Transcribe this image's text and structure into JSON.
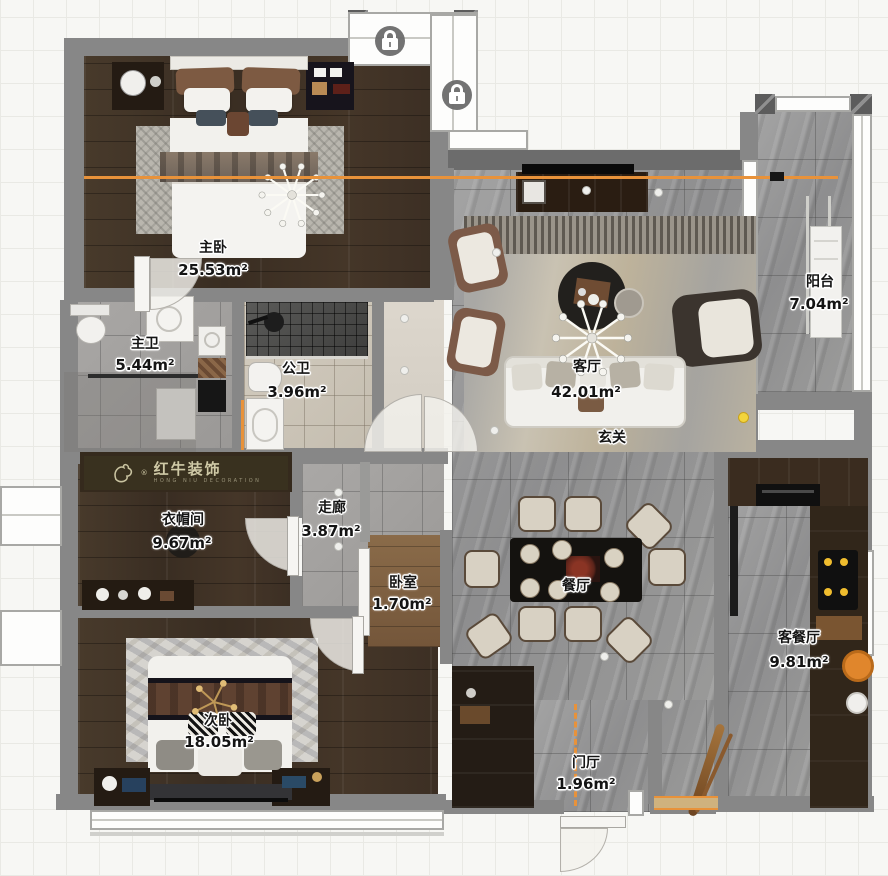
{
  "canvas": {
    "width": 888,
    "height": 876
  },
  "watermark": {
    "brand": "红牛装饰",
    "registered": "®",
    "sub": "HONG NIU DECORATION"
  },
  "rooms": [
    {
      "id": "master-bedroom",
      "label": "主卧",
      "area": "25.53m²"
    },
    {
      "id": "master-bathroom",
      "label": "主卫",
      "area": "5.44m²"
    },
    {
      "id": "public-bathroom",
      "label": "公卫",
      "area": "3.96m²"
    },
    {
      "id": "living-room",
      "label": "客厅",
      "area": "42.01m²"
    },
    {
      "id": "hallway-foyer",
      "label": "玄关",
      "area": ""
    },
    {
      "id": "balcony",
      "label": "阳台",
      "area": "7.04m²"
    },
    {
      "id": "cloakroom",
      "label": "衣帽间",
      "area": "9.67m²"
    },
    {
      "id": "corridor",
      "label": "走廊",
      "area": "3.87m²"
    },
    {
      "id": "bedroom-nook",
      "label": "卧室",
      "area": "1.70m²"
    },
    {
      "id": "dining-room",
      "label": "餐厅",
      "area": ""
    },
    {
      "id": "kitchen-dining",
      "label": "客餐厅",
      "area": "9.81m²"
    },
    {
      "id": "second-bedroom",
      "label": "次卧",
      "area": "18.05m²"
    },
    {
      "id": "entry-hall",
      "label": "门厅",
      "area": "1.96m²"
    }
  ],
  "icons": [
    {
      "name": "lock-icon"
    },
    {
      "name": "lock-icon"
    }
  ],
  "colors": {
    "accent_orange": "#e8923a",
    "wall_gray": "#878787",
    "wood_dark": "#3f3226",
    "tile_gray": "#9a9a9a",
    "lock_badge": "#6c6c6c",
    "watermark_band": "#3a3220"
  }
}
